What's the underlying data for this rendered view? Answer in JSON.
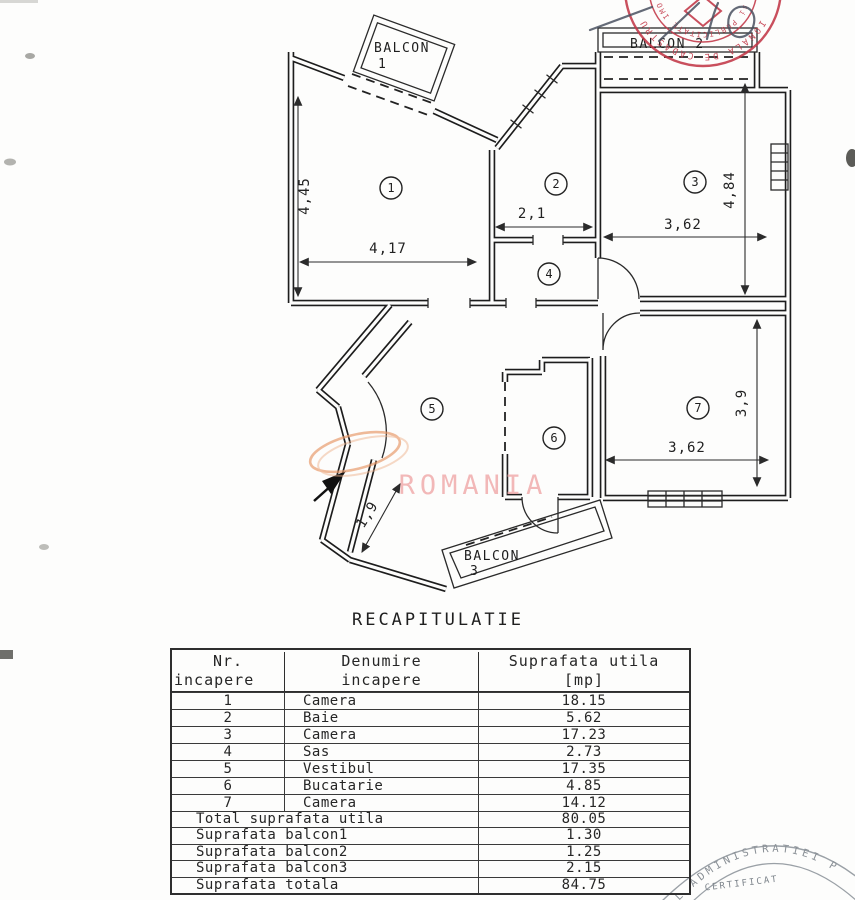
{
  "plan": {
    "balcony1_label_line1": "BALCON",
    "balcony1_label_line2": "1",
    "balcony2_label": "BALCON 2",
    "balcony3_label_line1": "BALCON",
    "balcony3_label_line2": "3",
    "rooms": [
      "1",
      "2",
      "3",
      "4",
      "5",
      "6",
      "7"
    ],
    "dims": {
      "room1_height": "4,45",
      "room1_width": "4,17",
      "room2_width": "2,1",
      "room3_height": "4,84",
      "room3_width": "3,62",
      "room7_width": "3,62",
      "room7_height": "3,9",
      "corridor": "1,9"
    },
    "watermark": {
      "text": "ROMANIA",
      "text_color": "#f0a8a8",
      "swoosh_color": "#e8996a"
    },
    "stamp_top": {
      "ring_text_outer": "IONALA DE CADASTRU",
      "ring_text_inner": "si PUBLICITATE IMO",
      "color": "#c23848"
    },
    "stamp_bottom": {
      "arc_text": "L ADMINISTRATIEI P",
      "line1": "CERTIFICAT",
      "color": "#878d93"
    }
  },
  "recap": {
    "title": "RECAPITULATIE",
    "col1_line1": "Nr.",
    "col1_line2": "incapere",
    "col2_line1": "Denumire",
    "col2_line2": "incapere",
    "col3_line1": "Suprafata utila",
    "col3_line2": "[mp]",
    "rows": [
      {
        "nr": "1",
        "name": "Camera",
        "area": "18.15"
      },
      {
        "nr": "2",
        "name": "Baie",
        "area": "5.62"
      },
      {
        "nr": "3",
        "name": "Camera",
        "area": "17.23"
      },
      {
        "nr": "4",
        "name": "Sas",
        "area": "2.73"
      },
      {
        "nr": "5",
        "name": "Vestibul",
        "area": "17.35"
      },
      {
        "nr": "6",
        "name": "Bucatarie",
        "area": "4.85"
      },
      {
        "nr": "7",
        "name": "Camera",
        "area": "14.12"
      }
    ],
    "summary": [
      {
        "label": "Total suprafata utila",
        "value": "80.05"
      },
      {
        "label": "Suprafata balcon1",
        "value": "1.30"
      },
      {
        "label": "Suprafata balcon2",
        "value": "1.25"
      },
      {
        "label": "Suprafata balcon3",
        "value": "2.15"
      },
      {
        "label": "Suprafata totala",
        "value": "84.75"
      }
    ]
  }
}
